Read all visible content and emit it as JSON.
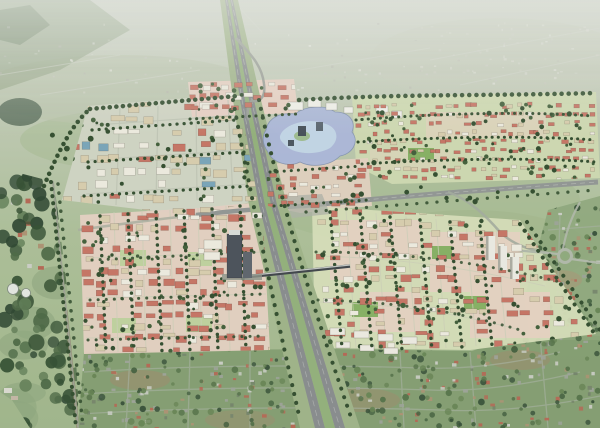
{
  "scene": {
    "type": "aerial-perspective-rendering",
    "subject": "Bird's-eye rendering of a new-town master plan: red-roofed housing districts and tree-lined boulevards straddling a widening motorway, with a lake quarter, landmark tower and pedestrian bridge, surrounded by existing hazy countryside and suburbs"
  },
  "palette": {
    "sky_top": "#ccd1c6",
    "sky_mid": "#b9c4ac",
    "field": "#a7bb92",
    "field_light": "#bcc7ac",
    "field_dark": "#93ab7d",
    "haze": "#e6e9e2",
    "hill_dark": "#6a8260",
    "forest_dark": "#2e4a2c",
    "forest_mid": "#47643f",
    "forest_light": "#6d8a58",
    "tree_dark": "#2c4828",
    "tree_mid": "#3c5a34",
    "dev_ground": "#ccd7ae",
    "dev_ground_gray": "#cfd3c2",
    "dev_pink": "#e8cfc2",
    "court_green": "#82ae5e",
    "roof_red": "#c4705f",
    "roof_red_dark": "#a85a4b",
    "building_white": "#eceade",
    "building_beige": "#d6cbaa",
    "building_blue": "#74a2b6",
    "tower_dark": "#454c54",
    "tower_dark2": "#596068",
    "bridge_dark": "#3a3f44",
    "road": "#8e9390",
    "road_light": "#a8b09e",
    "lane": "#b6bab6",
    "hw_pavement": "#84888a",
    "hw_median": "#8fae76",
    "hw_verge": "#9cb184",
    "water": "#a8b5d8",
    "water_light": "#c5dce8",
    "suburb_base": "#7e9a6c",
    "suburb_roof_red": "#b2624e",
    "suburb_roof_gray": "#9aa096",
    "suburb_white": "#c9ccc4",
    "suburb_tan": "#a98f6e",
    "soil": "#a08266",
    "distant_speck": "#d9dbd2",
    "watertower": "#e2e6e0"
  },
  "regions": [
    {
      "id": "distant-cityscape",
      "label": "Hazy existing city on the horizon"
    },
    {
      "id": "northern-boulevard",
      "label": "Tree-lined northern boundary boulevard"
    },
    {
      "id": "motorway",
      "label": "North-south motorway with green median"
    },
    {
      "id": "north-village",
      "label": "Pink north village blocks"
    },
    {
      "id": "northwest-district",
      "label": "Mixed-use midrise district"
    },
    {
      "id": "lake-quarter",
      "label": "Civic lake quarter with islands"
    },
    {
      "id": "northeast-housing-band",
      "label": "Rowhouse band east of the lake"
    },
    {
      "id": "east-arterial",
      "label": "East-west arterial road"
    },
    {
      "id": "central-south-district",
      "label": "Central-south housing district"
    },
    {
      "id": "west-south-district",
      "label": "Western housing district"
    },
    {
      "id": "landmark-tower",
      "label": "Dark landmark tower at motorway"
    },
    {
      "id": "pedestrian-bridge",
      "label": "Bridge crossing the motorway"
    },
    {
      "id": "white-slab-housing",
      "label": "White slab housing rows"
    },
    {
      "id": "roundabout",
      "label": "Existing roundabout east of the plan"
    },
    {
      "id": "left-forest-corridor",
      "label": "Wooded corridor along western edge"
    },
    {
      "id": "water-tower",
      "label": "White water tanks in the woods"
    },
    {
      "id": "existing-suburb",
      "label": "Existing low-rise suburb in the foreground"
    }
  ]
}
